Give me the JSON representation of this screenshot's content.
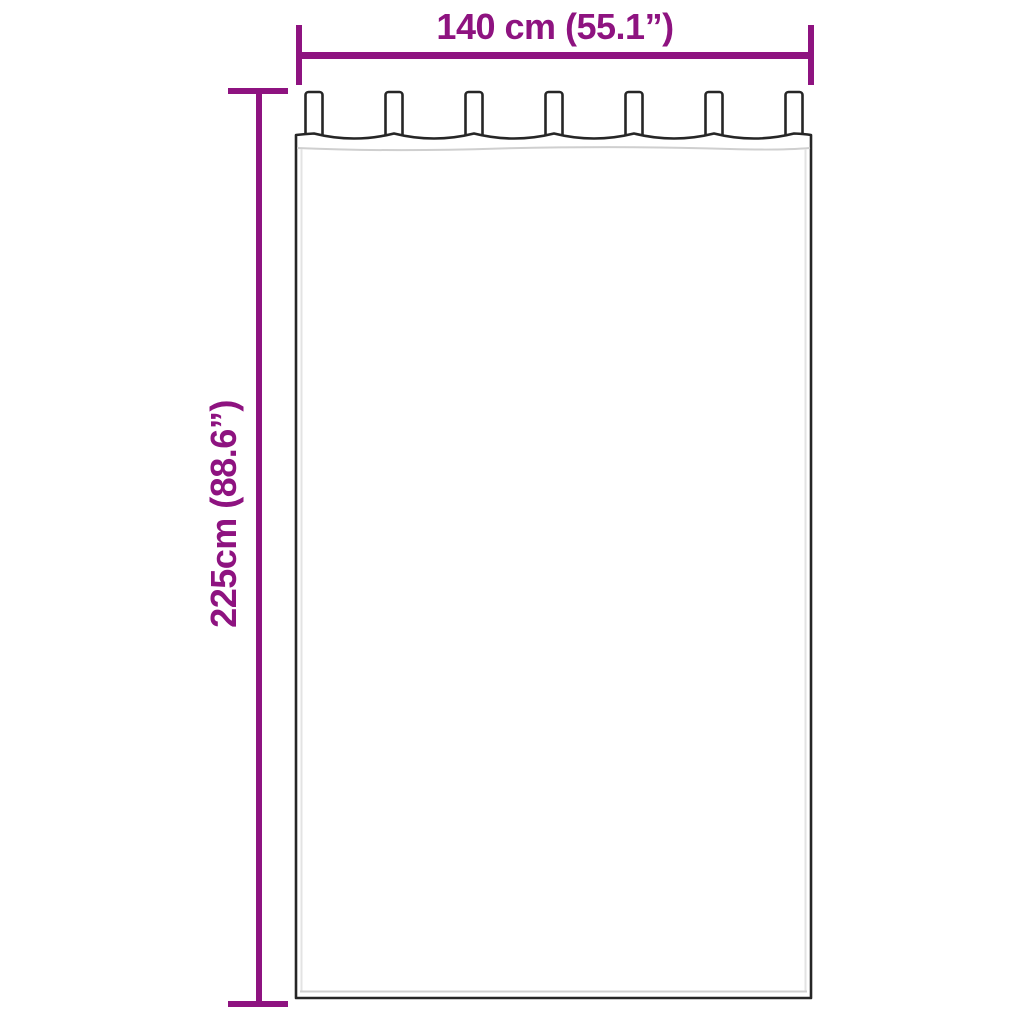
{
  "dimensions": {
    "width": {
      "label": "140 cm (55.1”)",
      "cm": "140",
      "inches": "55.1"
    },
    "height": {
      "label": "225cm (88.6”)",
      "cm": "225",
      "inches": "88.6"
    }
  },
  "curtain": {
    "tab_count": 7
  },
  "colors": {
    "accent": "#8e1380",
    "outline": "#262626",
    "seam": "#cfcfcf",
    "inner_line": "#e3e3e3",
    "background": "#ffffff"
  }
}
